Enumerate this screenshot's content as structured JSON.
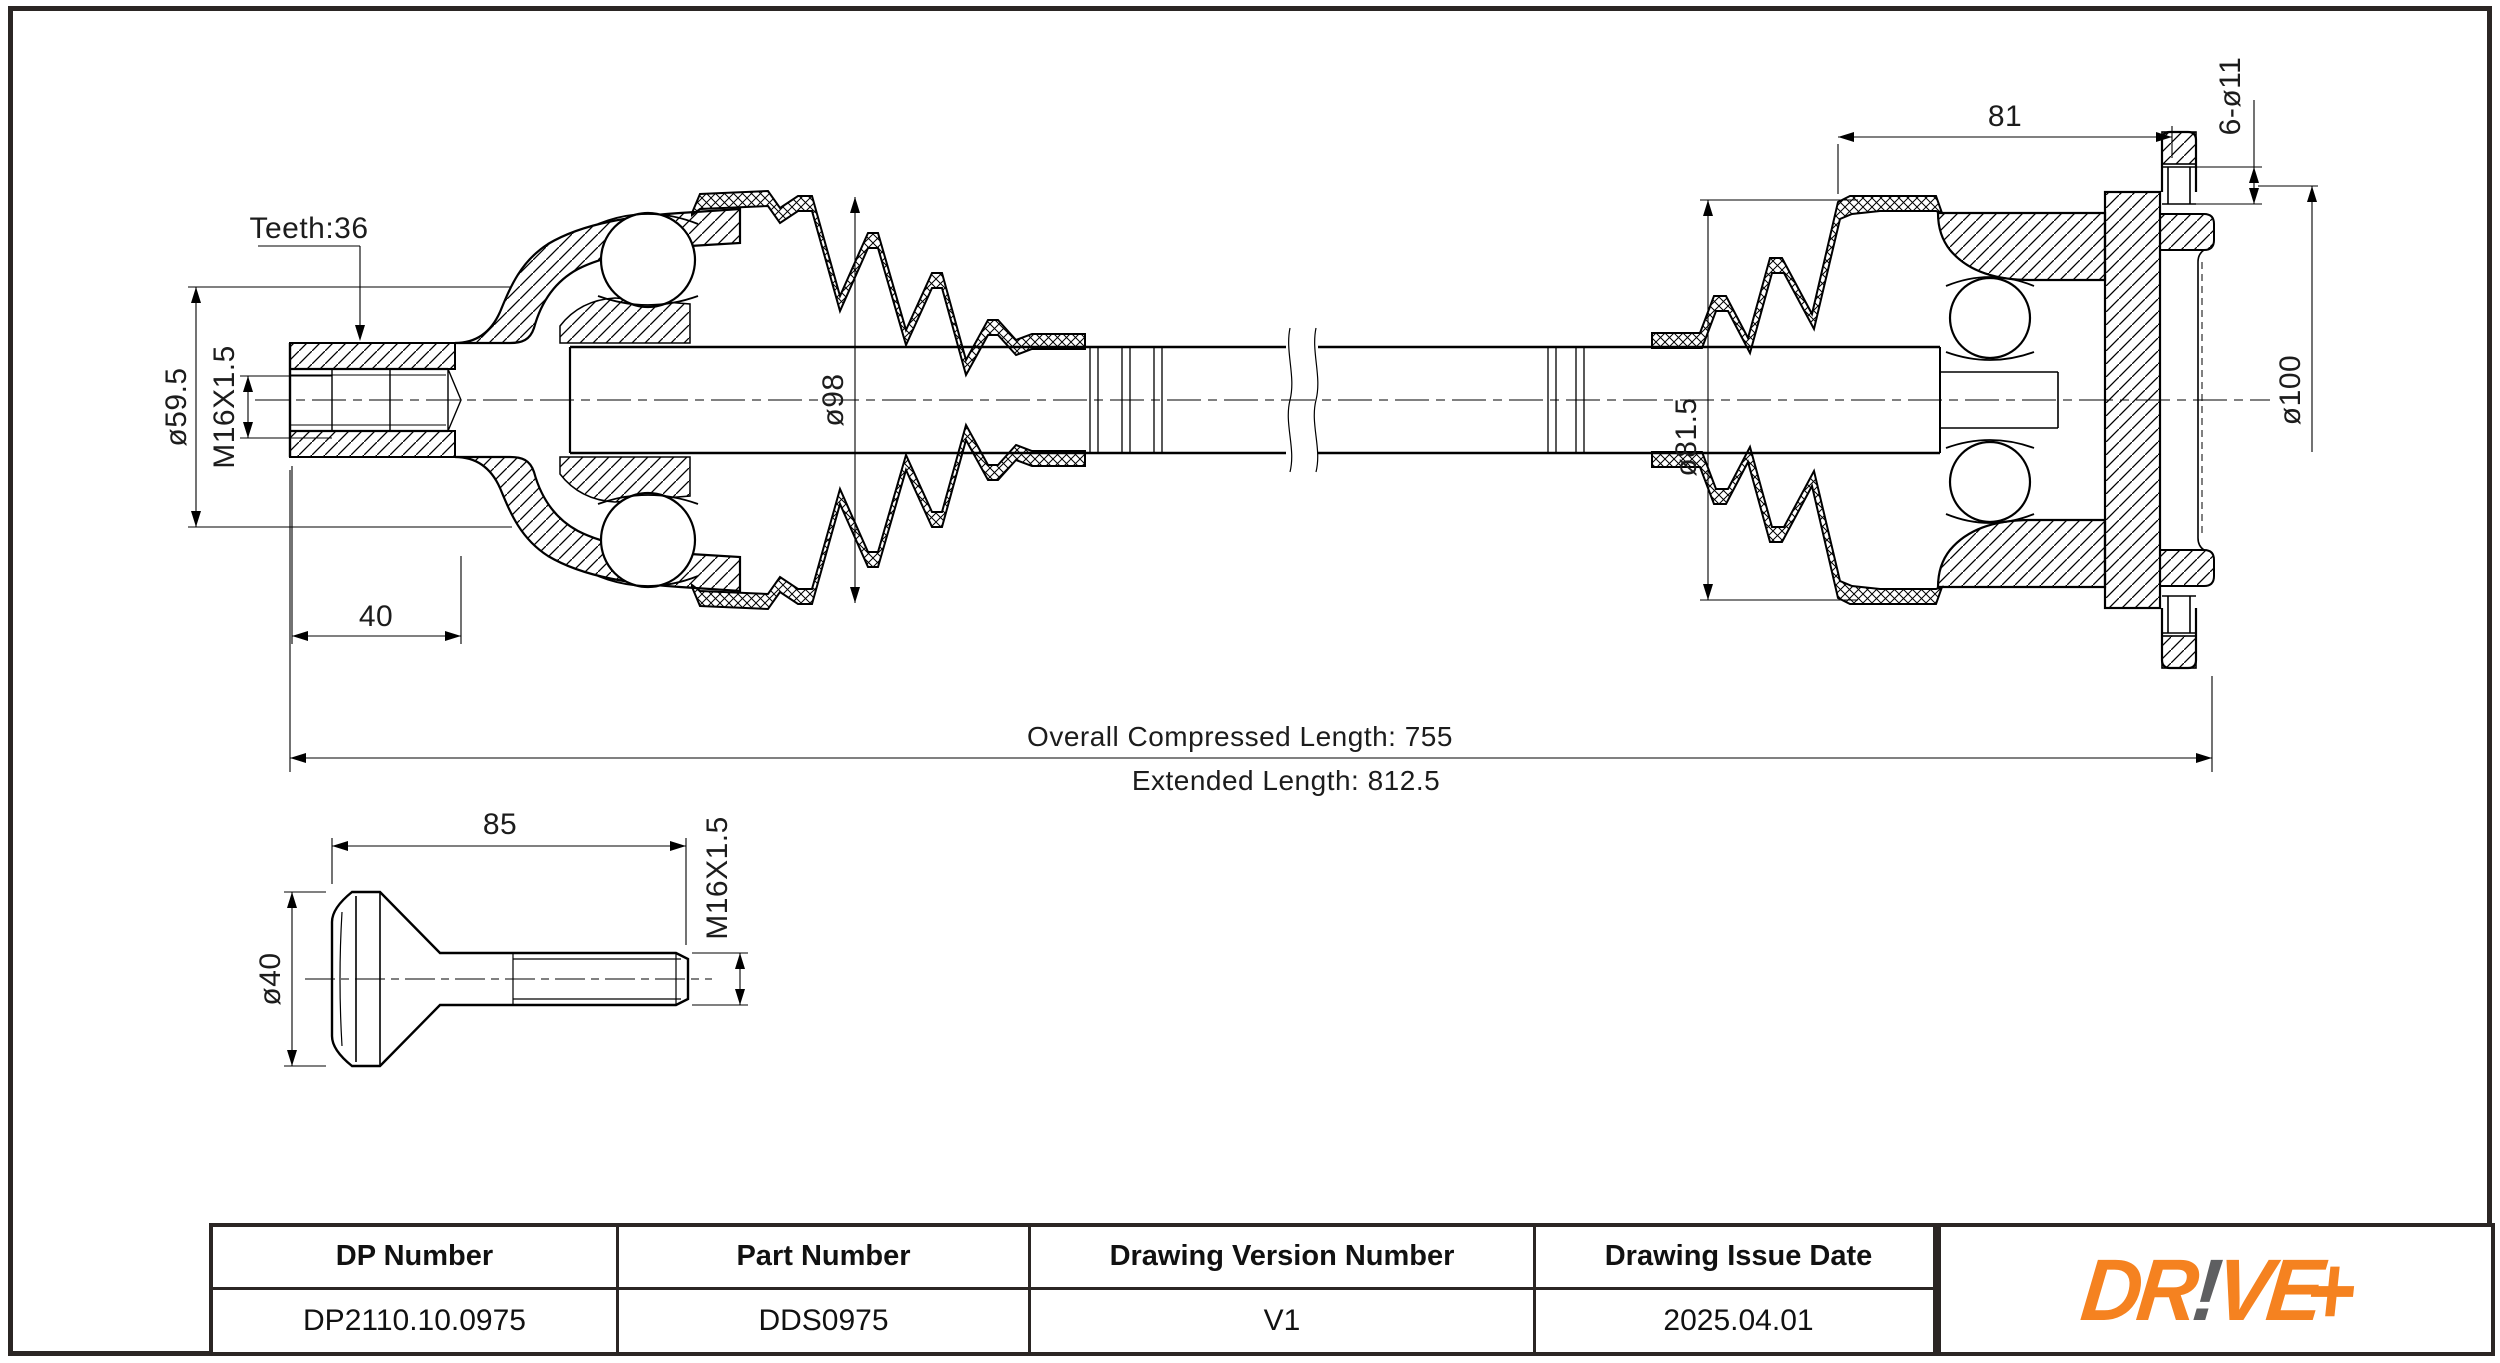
{
  "sheet": {
    "background_color": "#ffffff",
    "frame_color": "#2b2624",
    "line_color": "#000000",
    "description": "CV drive shaft technical drawing"
  },
  "drawing": {
    "dimensions": {
      "teeth": "Teeth:36",
      "stub_diameter": "ø59.5",
      "thread_main": "M16X1.5",
      "stub_length": "40",
      "outer_boot_diameter": "ø98",
      "inner_boot_diameter": "ø81.5",
      "inner_joint_length": "81",
      "bolt_holes": "6-ø11",
      "flange_diameter": "ø100",
      "compressed_length": "Overall  Compressed  Length: 755",
      "extended_length": "Extended  Length: 812.5",
      "bolt_length": "85",
      "bolt_thread": "M16X1.5",
      "bolt_head_diameter": "ø40"
    }
  },
  "title_block": {
    "headers": [
      "DP Number",
      "Part Number",
      "Drawing Version Number",
      "Drawing Issue Date"
    ],
    "values": [
      "DP2110.10.0975",
      "DDS0975",
      "V1",
      "2025.04.01"
    ],
    "columns": [
      {
        "label": "DP Number",
        "value": "DP2110.10.0975"
      },
      {
        "label": "Part Number",
        "value": "DDS0975"
      },
      {
        "label": "Drawing Version Number",
        "value": "V1"
      },
      {
        "label": "Drawing Issue Date",
        "value": "2025.04.01"
      }
    ]
  },
  "logo": {
    "text": "DR!VE+",
    "segment_dr": "DR",
    "segment_bang": "!",
    "segment_ve": "VE",
    "segment_plus": "+",
    "orange": "#f58220",
    "gray": "#5e5f61"
  }
}
